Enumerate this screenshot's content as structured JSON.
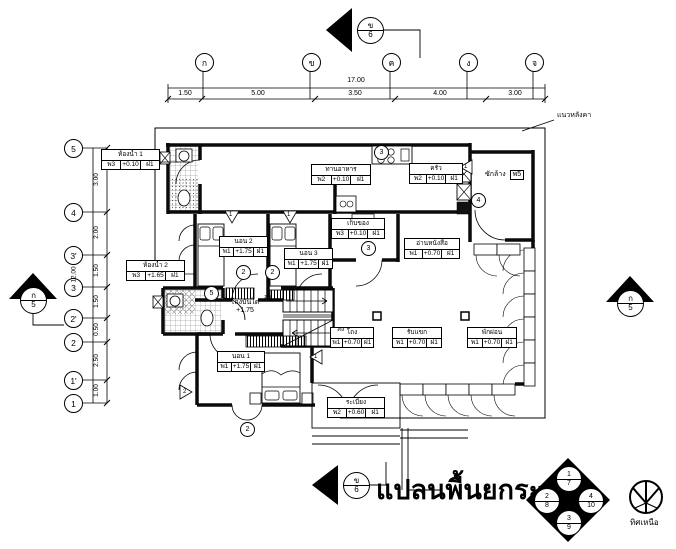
{
  "title": "แปลนพื้นยกระดับ",
  "north_label": "ทิศเหนือ",
  "roof_note": "แนวหลังคา",
  "grid": {
    "cols": [
      "ก",
      "ข",
      "ค",
      "ง",
      "จ"
    ],
    "col_total": "17.00",
    "col_segments": [
      "1.50",
      "5.00",
      "3.50",
      "4.00",
      "3.00"
    ],
    "rows": [
      "5",
      "4",
      "3'",
      "3",
      "2'",
      "2",
      "1'",
      "1"
    ],
    "row_total": "12.00",
    "row_segments": [
      "3.00",
      "2.00",
      "1.50",
      "1.50",
      "0.50",
      "2.50",
      "1.00"
    ]
  },
  "markers": {
    "top": {
      "letter": "ข",
      "num": "6"
    },
    "bottom": {
      "letter": "ข",
      "num": "6"
    },
    "left": {
      "letter": "ก",
      "num": "5"
    },
    "right": {
      "letter": "ก",
      "num": "5"
    }
  },
  "detail_symbol": {
    "top": [
      "1",
      "7"
    ],
    "left": [
      "2",
      "8"
    ],
    "right": [
      "4",
      "10"
    ],
    "bottom": [
      "3",
      "9"
    ]
  },
  "rooms": {
    "bath1": {
      "name": "ห้องน้ำ 1",
      "floor": "พ3",
      "level": "+0.10",
      "wall": "ฝ1"
    },
    "dining": {
      "name": "ทานอาหาร",
      "floor": "พ2",
      "level": "+0.10",
      "wall": "ฝ1"
    },
    "kitchen": {
      "name": "ครัว",
      "floor": "พ2",
      "level": "+0.10",
      "wall": "ฝ1"
    },
    "laundry": {
      "name": "ซักล้าง",
      "floor": "พ5"
    },
    "bed2": {
      "name": "นอน 2",
      "floor": "พ1",
      "level": "+1.75",
      "wall": "ฝ1"
    },
    "bed3": {
      "name": "นอน 3",
      "floor": "พ1",
      "level": "+1.75",
      "wall": "ฝ1"
    },
    "storage": {
      "name": "เก็บของ",
      "floor": "พ3",
      "level": "+0.10",
      "wall": "ฝ1"
    },
    "reading": {
      "name": "อ่านหนังสือ",
      "floor": "พ1",
      "level": "+0.70",
      "wall": "ฝ1"
    },
    "bath2": {
      "name": "ห้องน้ำ 2",
      "floor": "พ3",
      "level": "+1.65",
      "wall": "ฝ1"
    },
    "stairhall": {
      "name": "โถงบันได",
      "level": "+1.75"
    },
    "bed1": {
      "name": "นอน 1",
      "floor": "พ1",
      "level": "+1.75",
      "wall": "ฝ1"
    },
    "hall": {
      "name": "โถง",
      "floor": "พ1",
      "level": "+0.70",
      "wall": "ฝ1"
    },
    "living": {
      "name": "รับแขก",
      "floor": "พ1",
      "level": "+0.70",
      "wall": "ฝ1"
    },
    "relax": {
      "name": "พักผ่อน",
      "floor": "พ1",
      "level": "+0.70",
      "wall": "ฝ1"
    },
    "balcony": {
      "name": "ระเบียง",
      "floor": "พ2",
      "level": "+0.60",
      "wall": "ฝ1"
    }
  },
  "stairs": {
    "down1": "ลง",
    "down2": "ลง"
  },
  "tags": {
    "c": [
      "3",
      "4",
      "3",
      "2",
      "2",
      "5",
      "2"
    ],
    "w": [
      "1",
      "1",
      "1",
      "1",
      "2"
    ]
  }
}
